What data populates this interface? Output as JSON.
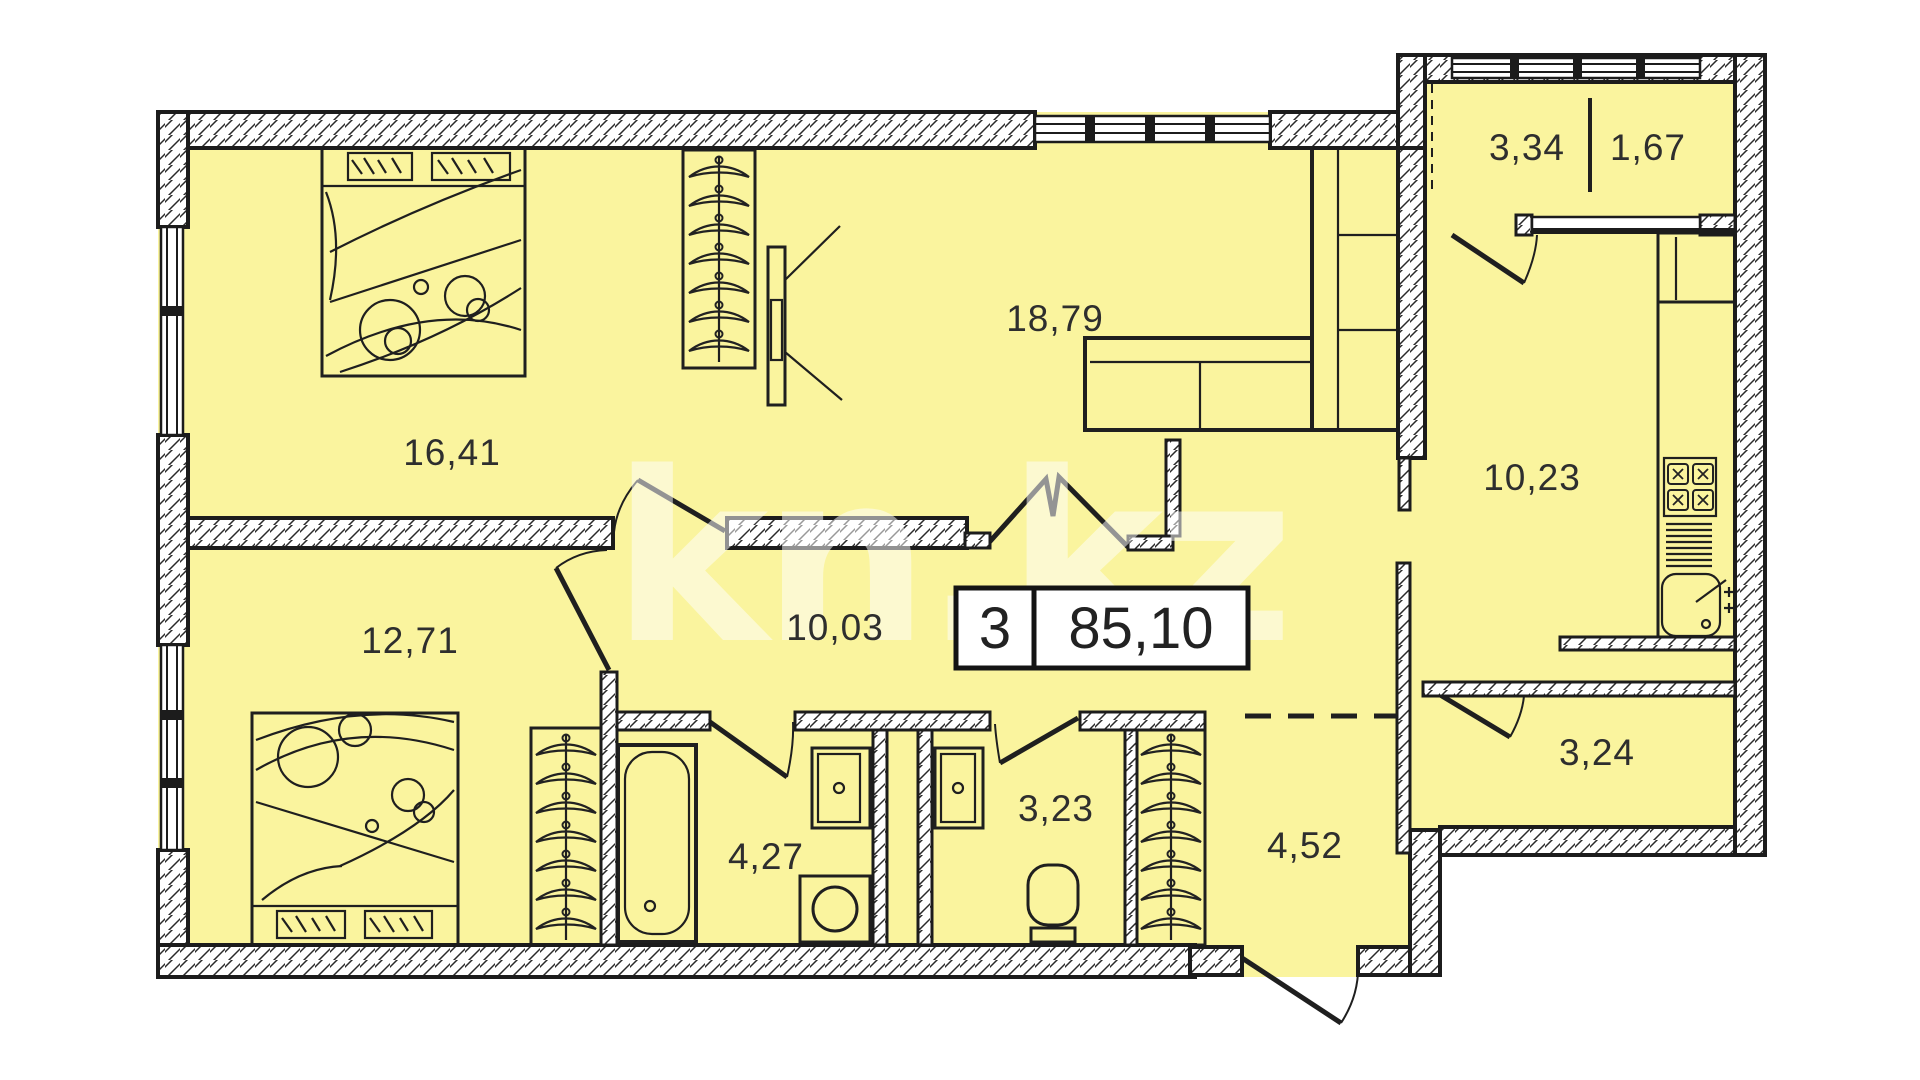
{
  "watermark": {
    "text": "kn.kz"
  },
  "badge": {
    "room_count": "3",
    "total_area": "85,10"
  },
  "rooms": [
    {
      "id": "bedroom-1",
      "area": "16,41"
    },
    {
      "id": "living-room",
      "area": "18,79"
    },
    {
      "id": "bedroom-2",
      "area": "12,71"
    },
    {
      "id": "hall",
      "area": "10,03"
    },
    {
      "id": "kitchen",
      "area": "10,23"
    },
    {
      "id": "balcony",
      "area_full": "3,34",
      "area_reduced": "1,67"
    },
    {
      "id": "entry-niche",
      "area": "3,24"
    },
    {
      "id": "bathroom",
      "area": "4,27"
    },
    {
      "id": "toilet",
      "area": "3,23"
    },
    {
      "id": "corridor",
      "area": "4,52"
    }
  ],
  "colors": {
    "floor": "#FAF49E",
    "wall_line": "#1c1c1c",
    "background": "#ffffff",
    "label_text": "#2e2e2e",
    "watermark": "#ffffff"
  }
}
